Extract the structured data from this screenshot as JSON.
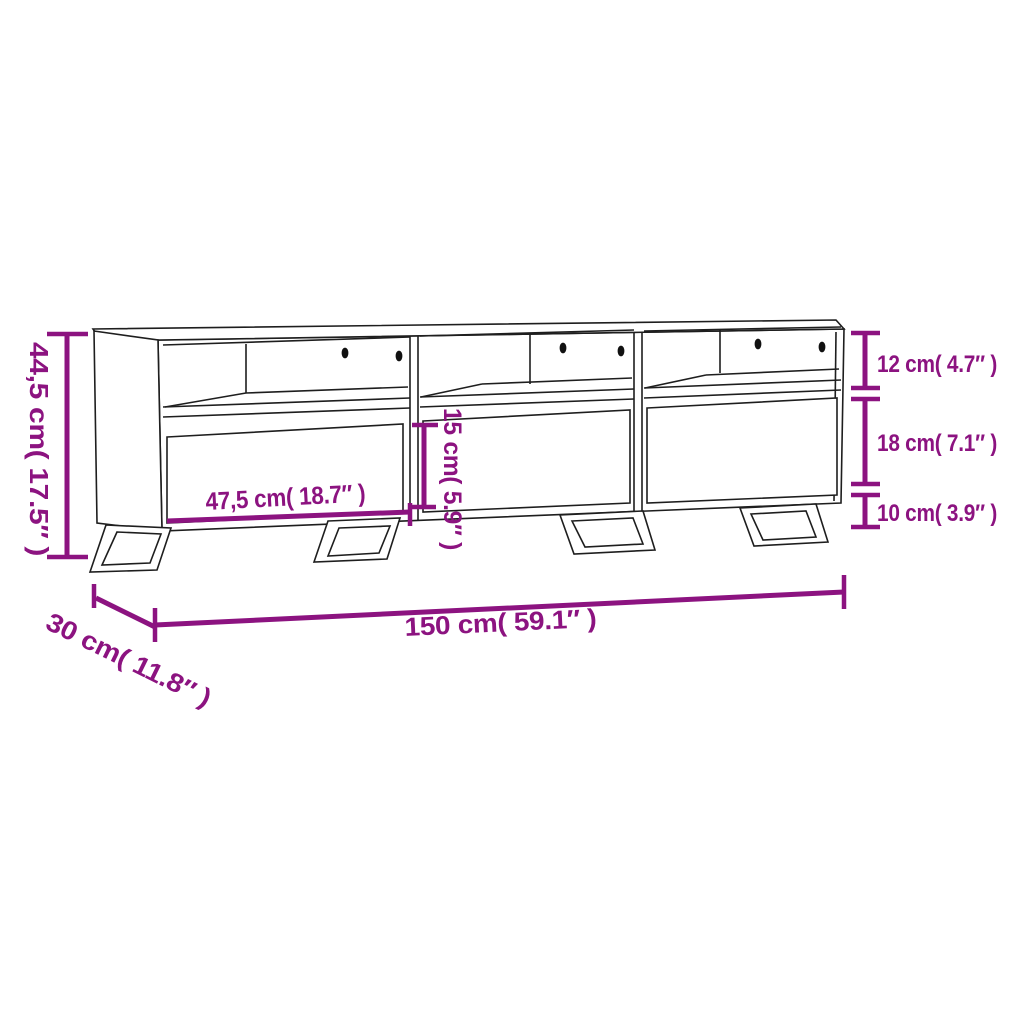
{
  "diagram_type": "product-dimension-drawing",
  "product": "tv-cabinet-3-sections",
  "colors": {
    "accent": "#8c1380",
    "outline": "#1e1e1e",
    "background": "#ffffff"
  },
  "labels": {
    "height": "44,5 cm( 17.5″ )",
    "shelf_opening": "12 cm( 4.7″ )",
    "drawer_front": "18 cm( 7.1″ )",
    "leg_height": "10 cm( 3.9″ )",
    "drawer_width": "47,5 cm( 18.7″ )",
    "inner_height": "15 cm( 5.9″ )",
    "width": "150 cm( 59.1″ )",
    "depth": "30 cm( 11.8″ )"
  }
}
